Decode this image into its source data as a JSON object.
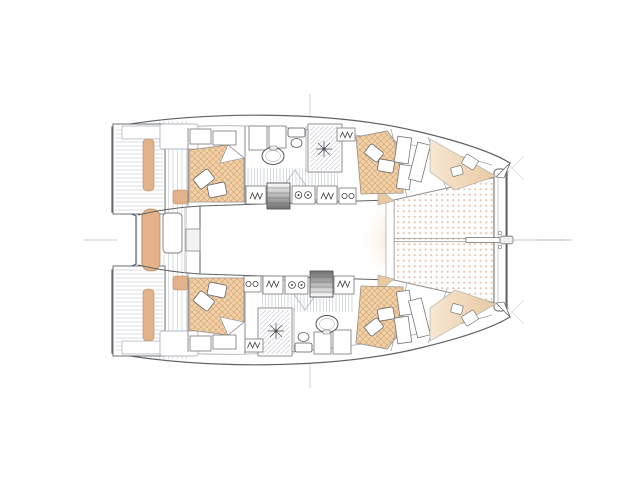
{
  "figure": {
    "kind": "catamaran-deck-plan",
    "view": "top-down",
    "background": "#ffffff"
  },
  "features": {
    "stern": "swim-platforms",
    "cockpit": "aft-cockpit",
    "saloon": "saloon",
    "hulls": [
      "port-hull",
      "starboard-hull"
    ],
    "cabins": [
      "aft-cabin",
      "forward-cabin",
      "forepeak-berth"
    ],
    "wet_areas": [
      "bathroom-shower",
      "sink",
      "toilet"
    ],
    "galley": "galley-units",
    "stairs": "companionway-stairs",
    "bow": [
      "trampoline",
      "forebeam",
      "bowsprit",
      "forestay"
    ]
  },
  "colors": {
    "outline": "#5f6266",
    "outline_soft": "#9aa0a6",
    "cushion": "#e3b28b",
    "cushion_edge": "#b98e62",
    "mattress": "#f0d2a9",
    "mattress_hatch": "#d9a878",
    "deck_soft": "#f6e7d2",
    "deck_soft_deep": "#e9c9a2",
    "trampoline_dot": "#e5c6b0",
    "plank_line": "#d2d6da",
    "hatch_line": "#b9c0ca",
    "stair_light": "#fdfdfd",
    "stair_dark": "#6f6f6f",
    "guide": "#cccccc",
    "guide_faint": "#dddddd",
    "fixture": "#4a4a4a",
    "white": "#ffffff"
  }
}
